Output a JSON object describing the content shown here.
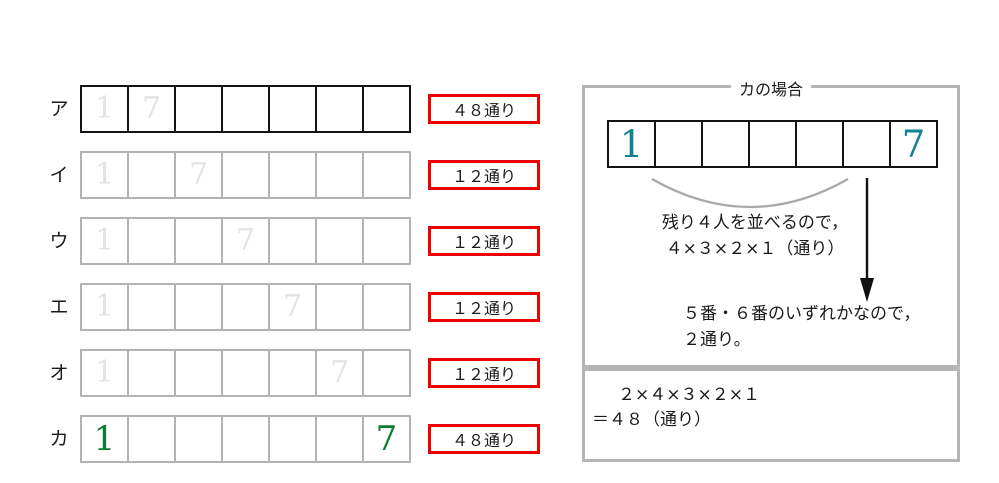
{
  "colors": {
    "red_badge_border": "#ee0000",
    "black_cell_border": "#141414",
    "gray_cell_border": "#b3b3b3",
    "pale_digit": "#e3e3e3",
    "green_digit": "#0e7d31",
    "teal_digit": "#15808f",
    "panel_border": "#b5b5b5",
    "arc_stroke": "#a8a8a8"
  },
  "rows": [
    {
      "label": "ア",
      "count": "４８通り",
      "cells": [
        "1",
        "7",
        "",
        "",
        "",
        "",
        ""
      ]
    },
    {
      "label": "イ",
      "count": "１２通り",
      "cells": [
        "1",
        "",
        "7",
        "",
        "",
        "",
        ""
      ]
    },
    {
      "label": "ウ",
      "count": "１２通り",
      "cells": [
        "1",
        "",
        "",
        "7",
        "",
        "",
        ""
      ]
    },
    {
      "label": "エ",
      "count": "１２通り",
      "cells": [
        "1",
        "",
        "",
        "",
        "7",
        "",
        ""
      ]
    },
    {
      "label": "オ",
      "count": "１２通り",
      "cells": [
        "1",
        "",
        "",
        "",
        "",
        "7",
        ""
      ]
    },
    {
      "label": "カ",
      "count": "４８通り",
      "cells": [
        "1",
        "",
        "",
        "",
        "",
        "",
        "7"
      ]
    }
  ],
  "panel": {
    "title": "カの場合",
    "cells": [
      "1",
      "",
      "",
      "",
      "",
      "",
      "7"
    ],
    "note1_line1": "残り４人を並べるので，",
    "note1_line2": "４×３×２×１（通り）",
    "note2_line1": "５番・６番のいずれかなので，",
    "note2_line2": "２通り。",
    "formula_line1": "２×４×３×２×１",
    "formula_line2": "＝４８（通り）"
  }
}
